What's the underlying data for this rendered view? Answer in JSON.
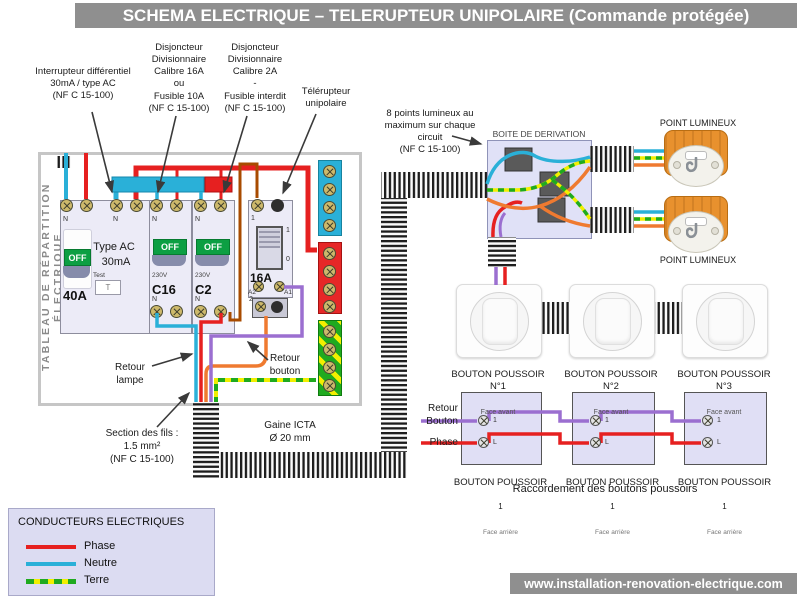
{
  "title": "SCHEMA ELECTRIQUE – TELERUPTEUR UNIPOLAIRE (Commande protégée)",
  "footer": {
    "url": "www.installation-renovation-electrique.com"
  },
  "annotations": {
    "differential": "Interrupteur différentiel\n30mA / type AC\n(NF C 15-100)",
    "breaker16": "Disjoncteur\nDivisionnaire\nCalibre 16A\nou\nFusible 10A\n(NF C 15-100)",
    "breaker2": "Disjoncteur\nDivisionnaire\nCalibre 2A\n-\nFusible interdit\n(NF C 15-100)",
    "telerupteur": "Télérupteur\nunipolaire",
    "max_points": "8 points lumineux au\nmaximum sur chaque\ncircuit\n(NF C 15-100)",
    "retour_lampe": "Retour\nlampe",
    "retour_bouton": "Retour\nbouton",
    "wire_section": "Section des fils :\n1.5 mm²\n(NF C 15-100)",
    "gaine": "Gaine ICTA\nØ 20 mm"
  },
  "panel": {
    "side_label": "TABLEAU DE RÉPARTITION ÉLECTRIQUE",
    "differential": {
      "rating": "40A",
      "type": "Type AC",
      "sensitivity": "30mA",
      "test_label": "Test",
      "test_button": "T",
      "switch": "OFF",
      "neutral": "N"
    },
    "breaker16": {
      "rating": "C16",
      "voltage": "230V",
      "switch": "OFF",
      "neutral": "N"
    },
    "breaker2": {
      "rating": "C2",
      "voltage": "230V",
      "switch": "OFF",
      "neutral": "N"
    },
    "telerupteur": {
      "rating": "16A",
      "on": "1",
      "off": "0",
      "t_top": "1",
      "t_bottom": "2",
      "a1": "A1",
      "a2": "A2"
    }
  },
  "junction_box": {
    "label": "BOITE DE DERIVATION"
  },
  "light_points": {
    "label_top": "POINT LUMINEUX",
    "label_bottom": "POINT LUMINEUX"
  },
  "buttons_front": [
    {
      "title": "BOUTON POUSSOIR\nN°1",
      "sub": "Face avant"
    },
    {
      "title": "BOUTON POUSSOIR N°2",
      "sub": "Face avant"
    },
    {
      "title": "BOUTON POUSSOIR N°3",
      "sub": "Face avant"
    }
  ],
  "rear_diagram": {
    "wire_labels": {
      "retour_bouton": "Retour\nBouton",
      "phase": "Phase"
    },
    "boxes": [
      {
        "title": "BOUTON POUSSOIR",
        "num": "1",
        "sub": "Face arrière",
        "t1": "1",
        "t2": "L"
      },
      {
        "title": "BOUTON POUSSOIR",
        "num": "1",
        "sub": "Face arrière",
        "t1": "1",
        "t2": "L"
      },
      {
        "title": "BOUTON POUSSOIR",
        "num": "1",
        "sub": "Face arrière",
        "t1": "1",
        "t2": "L"
      }
    ],
    "caption": "Raccordement des boutons poussoirs"
  },
  "legend": {
    "title": "CONDUCTEURS ELECTRIQUES",
    "items": [
      {
        "label": "Phase",
        "color": "#e62020",
        "style": "solid"
      },
      {
        "label": "Neutre",
        "color": "#2ab0d8",
        "style": "solid"
      },
      {
        "label": "Terre",
        "color": "#1faa1f",
        "color2": "#f2ef00",
        "style": "dashed"
      }
    ]
  },
  "colors": {
    "title_bar": "#8f8f8f",
    "phase": "#e62020",
    "neutre": "#2ab0d8",
    "terre_green": "#1faa1f",
    "terre_yellow": "#f2ef00",
    "retour_lampe": "#ef7a30",
    "retour_bouton": "#9b6fd0",
    "derivation_feed": "#a84b00"
  }
}
